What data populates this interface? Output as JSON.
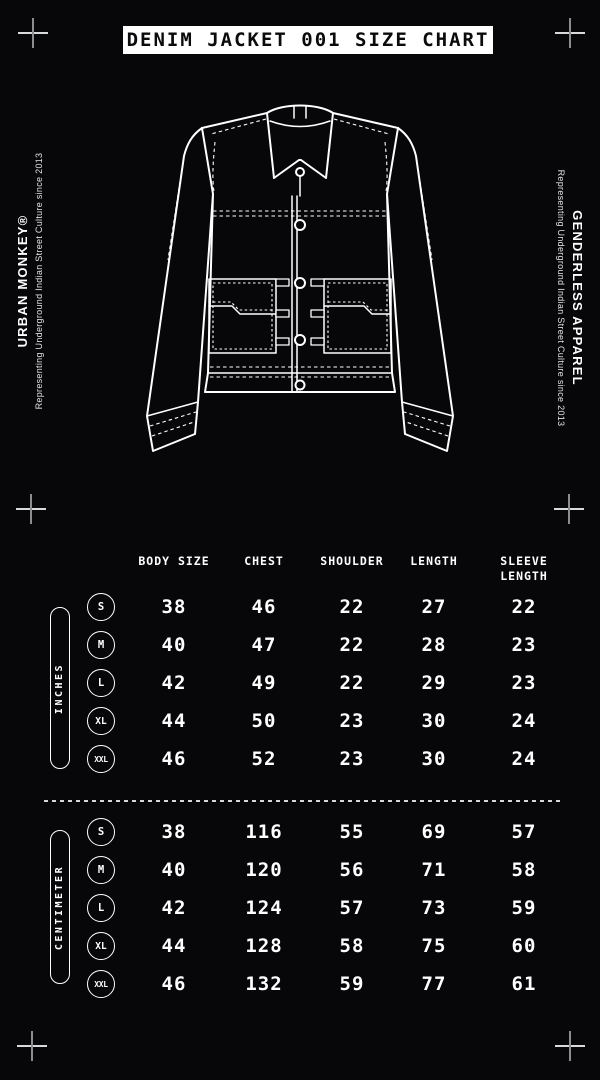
{
  "colors": {
    "background": "#070709",
    "foreground": "#ffffff"
  },
  "title": "DENIM JACKET 001 SIZE CHART",
  "branding": {
    "left": {
      "brand": "URBAN MONKEY®",
      "tagline": "Representing Underground Indian Street Culture since 2013"
    },
    "right": {
      "brand": "GENDERLESS APPAREL",
      "tagline": "Representing Underground Indian Street Culture since 2013"
    }
  },
  "size_chart": {
    "columns": [
      "BODY SIZE",
      "CHEST",
      "SHOULDER",
      "LENGTH",
      "SLEEVE LENGTH"
    ],
    "sections": [
      {
        "unit_label": "INCHES",
        "rows": [
          {
            "size": "S",
            "values": [
              38,
              46,
              22,
              27,
              22
            ]
          },
          {
            "size": "M",
            "values": [
              40,
              47,
              22,
              28,
              23
            ]
          },
          {
            "size": "L",
            "values": [
              42,
              49,
              22,
              29,
              23
            ]
          },
          {
            "size": "XL",
            "values": [
              44,
              50,
              23,
              30,
              24
            ]
          },
          {
            "size": "XXL",
            "values": [
              46,
              52,
              23,
              30,
              24
            ]
          }
        ]
      },
      {
        "unit_label": "CENTIMETER",
        "rows": [
          {
            "size": "S",
            "values": [
              38,
              116,
              55,
              69,
              57
            ]
          },
          {
            "size": "M",
            "values": [
              40,
              120,
              56,
              71,
              58
            ]
          },
          {
            "size": "L",
            "values": [
              42,
              124,
              57,
              73,
              59
            ]
          },
          {
            "size": "XL",
            "values": [
              44,
              128,
              58,
              75,
              60
            ]
          },
          {
            "size": "XXL",
            "values": [
              46,
              132,
              59,
              77,
              61
            ]
          }
        ]
      }
    ]
  }
}
